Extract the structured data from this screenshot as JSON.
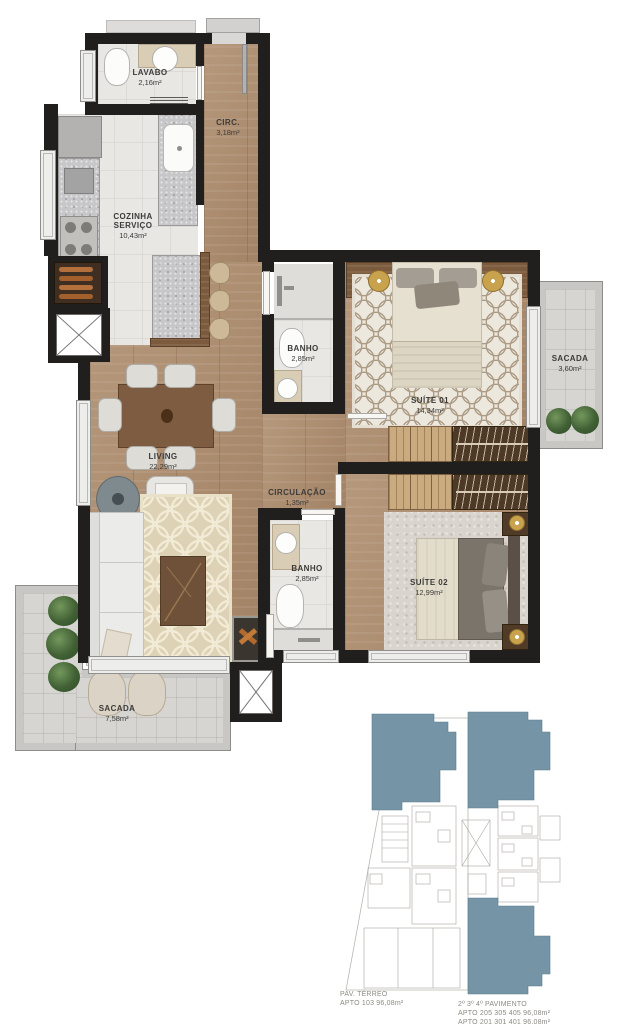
{
  "rooms": {
    "lavabo": {
      "name": "LAVABO",
      "area": "2,16m²"
    },
    "circ": {
      "name": "CIRC.",
      "area": "3,18m²"
    },
    "cozinha": {
      "name_line1": "COZINHA",
      "name_line2": "SERVIÇO",
      "area": "10,43m²"
    },
    "banho1": {
      "name": "BANHO",
      "area": "2,85m²"
    },
    "suite1": {
      "name": "SUÍTE 01",
      "area": "14,34m²"
    },
    "sacada_suite": {
      "name": "SACADA",
      "area": "3,60m²"
    },
    "living": {
      "name": "LIVING",
      "area": "22,29m²"
    },
    "circulacao": {
      "name": "CIRCULAÇÃO",
      "area": "1,35m²"
    },
    "banho2": {
      "name": "BANHO",
      "area": "2,85m²"
    },
    "suite2": {
      "name": "SUÍTE 02",
      "area": "12,99m²"
    },
    "sacada_living": {
      "name": "SACADA",
      "area": "7,58m²"
    }
  },
  "keyplans": {
    "terreo": {
      "caption": "PAV. TÉRREO\nAPTO 103 96,08m²"
    },
    "pavimentos": {
      "caption": "2º 3º 4º PAVIMENTO\nAPTO 205 305 405 96,08m²\nAPTO 201 301 401 96,08m²"
    }
  },
  "colors": {
    "wall": "#201f1d",
    "wood_floor": "#ae8d6e",
    "tile_floor": "#e9e7e4",
    "balcony_tile": "#d7d5d1",
    "highlight_unit_blue": "#7594a6",
    "keyplan_outline": "#a9a69f",
    "label_text": "#3c3b39"
  }
}
